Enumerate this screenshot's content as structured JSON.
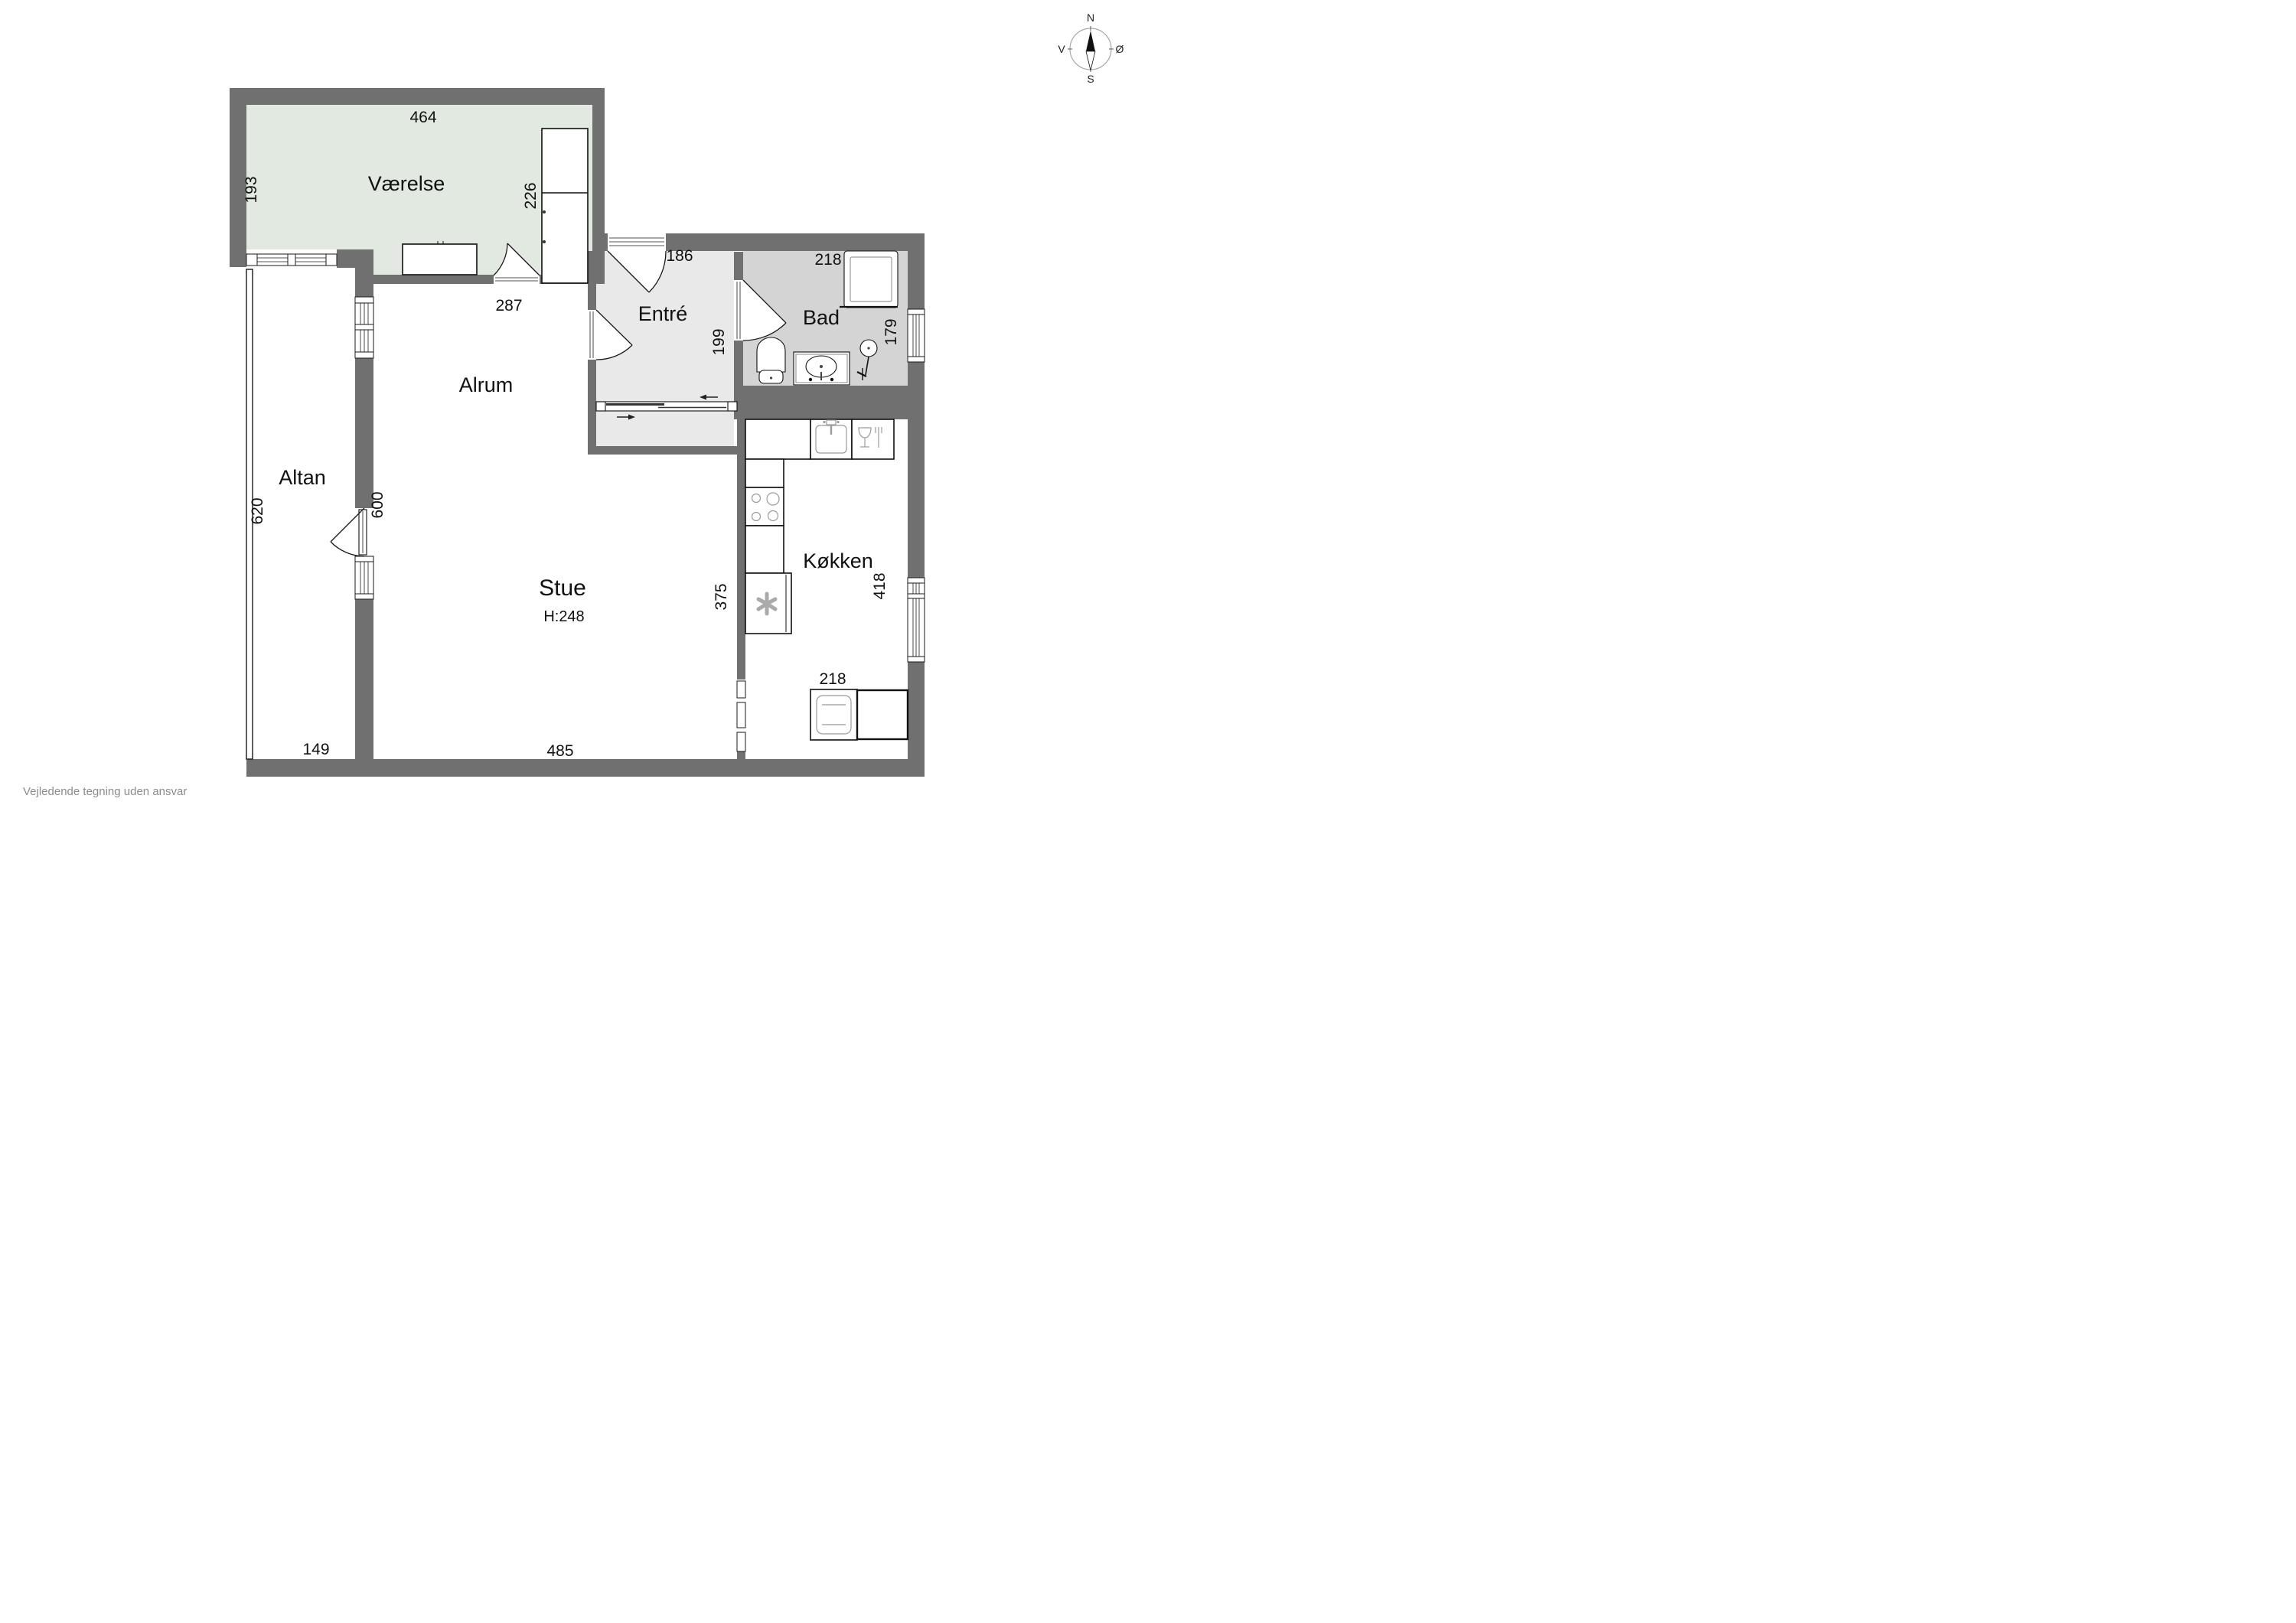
{
  "meta": {
    "disclaimer": "Vejledende tegning uden ansvar"
  },
  "compass": {
    "north": "N",
    "south": "S",
    "west": "V",
    "east": "Ø"
  },
  "rooms": {
    "vaerelse": {
      "label": "Værelse"
    },
    "alrum": {
      "label": "Alrum"
    },
    "altan": {
      "label": "Altan"
    },
    "entre": {
      "label": "Entré"
    },
    "bad": {
      "label": "Bad"
    },
    "stue": {
      "label": "Stue",
      "ceiling_height": "H:248"
    },
    "koekken": {
      "label": "Køkken"
    }
  },
  "dimensions": {
    "vaerelse": {
      "width": "464",
      "left_side": "193",
      "right_side": "226",
      "door_wall": "287"
    },
    "entre": {
      "width": "186",
      "depth": "199"
    },
    "bad": {
      "width": "218",
      "depth": "179"
    },
    "altan": {
      "length": "620",
      "bottom": "149"
    },
    "alrum": {
      "west_wall": "600"
    },
    "stue": {
      "width": "485"
    },
    "koekken": {
      "stue_wall": "375",
      "depth": "418",
      "bottom": "218"
    }
  },
  "colors": {
    "wall": "#707070",
    "vaerelse_fill": "#e1e9e1",
    "entre_fill": "#e9e9e9",
    "bad_fill": "#d4d4d4",
    "background": "#ffffff",
    "outline": "#1a1a1a",
    "detail": "#9b9b9b",
    "footer_text": "#8c8c8c"
  }
}
